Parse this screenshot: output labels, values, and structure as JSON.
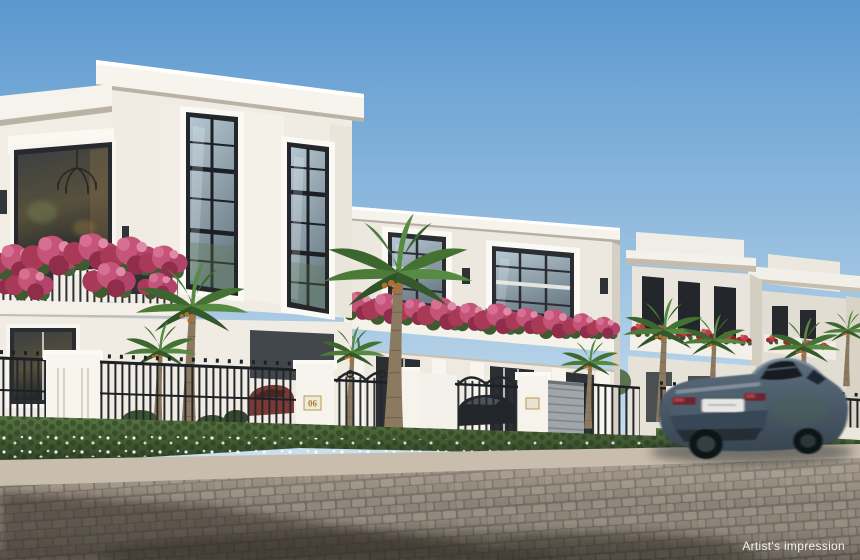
{
  "caption": {
    "text": "Artist's impression",
    "color": "#f2f1ef"
  },
  "signage": {
    "house_number": "06",
    "plaque_text_color": "#a9832e"
  },
  "palette": {
    "sky_top": "#5b98cf",
    "sky_horizon": "#cfe3ef",
    "villa_wall": "#f0ece3",
    "villa_trim": "#f7f4ee",
    "cornice_underside": "#b9b2a5",
    "window_frame": "#23262a",
    "glass_light": "#b5c7d2",
    "glass_dark": "#6f7f89",
    "bougainvillea_pink": "#c45578",
    "bougainvillea_deep": "#a83a58",
    "flower_red": "#b84043",
    "palm_frond": "#4b7a39",
    "palm_trunk": "#8b7a60",
    "hedge_light": "#577441",
    "hedge_dark": "#2e4026",
    "iron_black": "#23272c",
    "pillar_white": "#f8f5ef",
    "sidewalk": "#c9bead",
    "road": "#8d8379",
    "shadow": "#2f2b26",
    "car_body_light": "#5d6f80",
    "car_body_dark": "#384551",
    "car_glass": "#141c24",
    "taillight_red": "#6b2833",
    "license_plate": "#e6e6e2"
  },
  "scene": {
    "description": "Street-level artist's impression of a row of white classical villas with pink bougainvillea balconies, palm trees, black iron fences and gates, a hedge with white flowers, and a sedan driving past on a cobbled street.",
    "objects": [
      "sky",
      "villa row",
      "balcony flowers",
      "palm trees",
      "iron fence and gates",
      "gate pillar 06",
      "hedge with white flowers",
      "sidewalk",
      "cobblestone street",
      "driving sedan",
      "parked cars"
    ]
  }
}
